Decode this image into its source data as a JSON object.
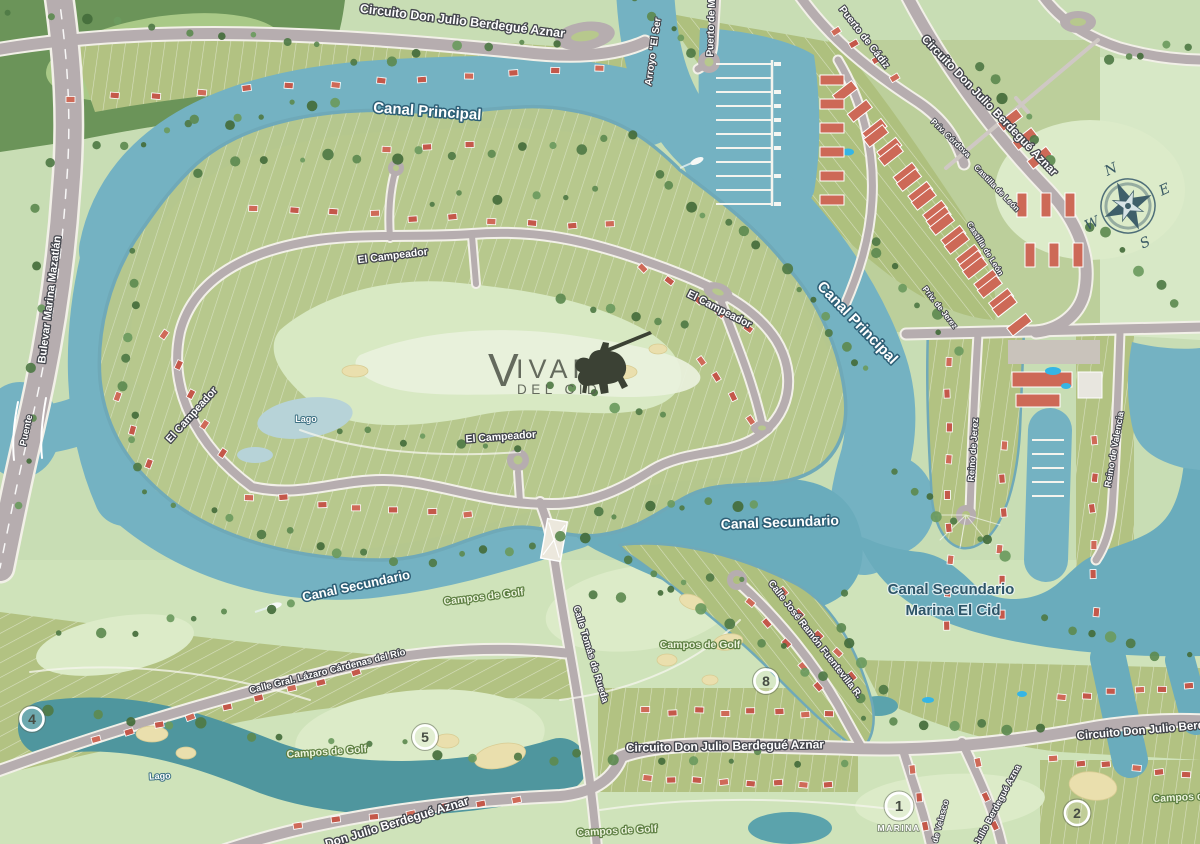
{
  "map": {
    "logo": {
      "v": "V",
      "ivar": "IVAR",
      "subtitle": "DEL CID"
    },
    "compass": {
      "n": "N",
      "e": "E",
      "s": "S",
      "w": "W"
    },
    "labels": {
      "circuito_don_julio": "Circuito Don Julio Berdegué Aznar",
      "circuito_partial": "Circuito Don Julio Berd",
      "don_julio": "Don Julio Berdegué Aznar",
      "julio_berdegue_partial": "Julio Berdegué Azna",
      "arroyo": "Arroyo \"El Ser",
      "puerto_de_m": "Puerto de M",
      "puerto_de_cadiz": "Puerto de Cádiz",
      "priv_cordova": "Priv. Córdova",
      "castilla_de_leon": "Castilla de León",
      "priv_de_jerez": "Priv. de Jerez",
      "reino_de_jerez": "Reino de Jerez",
      "reino_de_valencia": "Reino de Valencia",
      "canal_principal": "Canal Principal",
      "canal_secundario": "Canal Secundario",
      "marina_el_cid": "Marina El Cid",
      "el_campeador": "El Campeador",
      "campos_de_golf": "Campos de Golf",
      "calle_lazaro": "Calle Gral. Lázaro Cárdenas del Río",
      "calle_tomas": "Calle Tomás de Rueda",
      "calle_jose": "Calle José Ramón Fuentevilla R.",
      "bulevar": "Bulevar  Marina Mazatlán",
      "puente": "Puente",
      "de_velasco": "de Velasco",
      "lago": "Lago"
    },
    "markers": {
      "m1": {
        "number": "1",
        "label": "MARINA"
      },
      "m2": {
        "number": "2"
      },
      "m4": {
        "number": "4"
      },
      "m5": {
        "number": "5"
      },
      "m8": {
        "number": "8"
      }
    },
    "colors": {
      "water": "#74b2c2",
      "deep_water": "#6aacbc",
      "lake": "#4f969e",
      "land": "#c8ddb4",
      "golf_light": "#d8e9c3",
      "lots_olive": "#b2c282",
      "road": "#b6adaf",
      "roof_red": "#c4584a",
      "forest": "#5d8a54"
    }
  }
}
